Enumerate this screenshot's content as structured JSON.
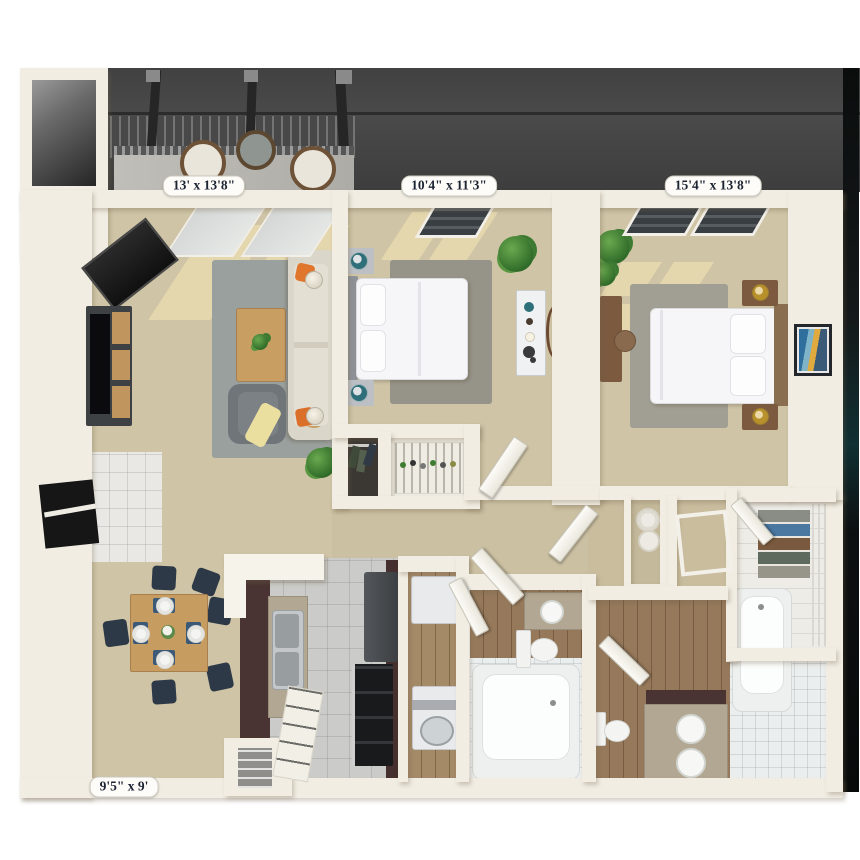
{
  "floor_plan": {
    "description": "3D top-down floor plan of a two-bedroom, two-bath apartment with balcony",
    "dimension_labels": [
      {
        "room": "balcony-living-room",
        "text": "13' x 13'8\""
      },
      {
        "room": "bedroom-1",
        "text": "10'4\" x 11'3\""
      },
      {
        "room": "bedroom-2",
        "text": "15'4\" x 13'8\""
      },
      {
        "room": "dining-room",
        "text": "9'5\" x 9'"
      }
    ],
    "rooms": [
      {
        "name": "balcony",
        "furniture": [
          "pergola",
          "patio-chair",
          "patio-chair",
          "patio-table",
          "railing"
        ]
      },
      {
        "name": "living-room",
        "furniture": [
          "fireplace",
          "tv-stand",
          "sofa",
          "coffee-table",
          "armchair",
          "side-table-lamp",
          "side-table-lamp",
          "area-rug",
          "plant"
        ]
      },
      {
        "name": "dining-room",
        "furniture": [
          "dining-table",
          "dining-chairs",
          "place-settings"
        ]
      },
      {
        "name": "kitchen",
        "furniture": [
          "breakfast-bar",
          "double-sink",
          "refrigerator",
          "range",
          "pantry",
          "shelving-unit"
        ]
      },
      {
        "name": "laundry",
        "furniture": [
          "washer",
          "dryer"
        ]
      },
      {
        "name": "bedroom-1",
        "furniture": [
          "bed",
          "nightstand",
          "nightstand",
          "dresser",
          "mirror",
          "closet",
          "area-rug",
          "plant",
          "window"
        ]
      },
      {
        "name": "bedroom-2",
        "furniture": [
          "bed",
          "nightstand",
          "nightstand",
          "desk",
          "wall-art",
          "area-rug",
          "plants",
          "windows"
        ]
      },
      {
        "name": "bathroom-1",
        "furniture": [
          "vanity-sink",
          "toilet",
          "bathtub"
        ]
      },
      {
        "name": "bathroom-2",
        "furniture": [
          "double-vanity",
          "toilet",
          "bathtub",
          "mirror"
        ]
      },
      {
        "name": "walk-in-closet",
        "furniture": [
          "clothes-shelves",
          "closet-rod"
        ]
      },
      {
        "name": "linen-closet",
        "furniture": [
          "towels"
        ]
      }
    ],
    "colors": {
      "wall": "#f1ede3",
      "carpet": "#cfc4a6",
      "carpet_sunlight": "#f2e2b2",
      "area_rug": "#9aa09d",
      "pergola_roof": "#454545",
      "kitchen_tile": "#cbcbc9",
      "wood_floor": "#96795b",
      "espresso_cabinet": "#4a3433",
      "granite_counter": "#b2a792",
      "accent_orange": "#e0762c",
      "accent_teal": "#2e6f7a",
      "chair_navy": "#2e3947",
      "wood_furniture": "#c79c61",
      "label_text": "#1c2433"
    }
  }
}
